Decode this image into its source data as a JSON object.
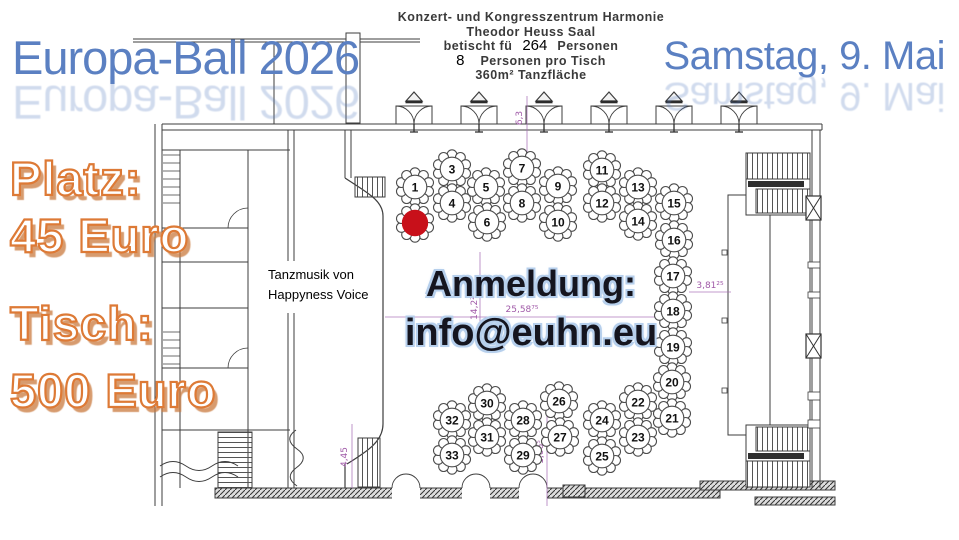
{
  "poster": {
    "title": "Europa-Ball 2026",
    "date": "Samstag, 9. Mai",
    "venue": {
      "line1": "Konzert- und Kongresszentrum Harmonie",
      "line2": "Theodor Heuss Saal",
      "seated_prefix": "betischt fü",
      "seated_count": "264",
      "seated_suffix": "Personen",
      "per_table_count": "8",
      "per_table_text": "Personen pro Tisch",
      "dance_floor": "360m² Tanzfläche"
    },
    "prices": {
      "seat_label": "Platz:",
      "seat_value": "45 Euro",
      "table_label": "Tisch:",
      "table_value": "500 Euro"
    },
    "music": {
      "line1": "Tanzmusik von",
      "line2": "Happyness Voice"
    },
    "registration": {
      "label": "Anmeldung:",
      "email": "info@euhn.eu"
    }
  },
  "floorplan": {
    "tables": [
      {
        "n": "1",
        "x": 415,
        "y": 187
      },
      {
        "n": "3",
        "x": 452,
        "y": 169
      },
      {
        "n": "4",
        "x": 452,
        "y": 203
      },
      {
        "n": "5",
        "x": 486,
        "y": 187
      },
      {
        "n": "6",
        "x": 487,
        "y": 222
      },
      {
        "n": "7",
        "x": 522,
        "y": 168
      },
      {
        "n": "8",
        "x": 522,
        "y": 203
      },
      {
        "n": "9",
        "x": 558,
        "y": 186
      },
      {
        "n": "10",
        "x": 558,
        "y": 222
      },
      {
        "n": "11",
        "x": 602,
        "y": 170
      },
      {
        "n": "12",
        "x": 602,
        "y": 203
      },
      {
        "n": "13",
        "x": 638,
        "y": 187
      },
      {
        "n": "14",
        "x": 638,
        "y": 221
      },
      {
        "n": "15",
        "x": 674,
        "y": 203
      },
      {
        "n": "16",
        "x": 674,
        "y": 240
      },
      {
        "n": "17",
        "x": 673,
        "y": 276
      },
      {
        "n": "18",
        "x": 673,
        "y": 311
      },
      {
        "n": "19",
        "x": 673,
        "y": 347
      },
      {
        "n": "20",
        "x": 672,
        "y": 382
      },
      {
        "n": "21",
        "x": 672,
        "y": 418
      },
      {
        "n": "22",
        "x": 638,
        "y": 402
      },
      {
        "n": "23",
        "x": 638,
        "y": 437
      },
      {
        "n": "24",
        "x": 602,
        "y": 420
      },
      {
        "n": "25",
        "x": 602,
        "y": 456
      },
      {
        "n": "26",
        "x": 559,
        "y": 401
      },
      {
        "n": "27",
        "x": 560,
        "y": 437
      },
      {
        "n": "28",
        "x": 523,
        "y": 420
      },
      {
        "n": "29",
        "x": 523,
        "y": 455
      },
      {
        "n": "30",
        "x": 487,
        "y": 403
      },
      {
        "n": "31",
        "x": 487,
        "y": 437
      },
      {
        "n": "32",
        "x": 452,
        "y": 420
      },
      {
        "n": "33",
        "x": 452,
        "y": 455
      }
    ],
    "sold_marker": {
      "x": 415,
      "y": 223
    },
    "dimensions": [
      {
        "text": "6,3",
        "x": 522,
        "y": 118,
        "rot": -90
      },
      {
        "text": "14,2²",
        "x": 477,
        "y": 308,
        "rot": -90
      },
      {
        "text": "25,58⁷⁵",
        "x": 522,
        "y": 312,
        "rot": 0
      },
      {
        "text": "3,81²⁵",
        "x": 710,
        "y": 288,
        "rot": 0
      },
      {
        "text": "4,45",
        "x": 347,
        "y": 457,
        "rot": -90
      },
      {
        "text": "1,66⁵",
        "x": 543,
        "y": 452,
        "rot": -90
      }
    ]
  },
  "colors": {
    "title_blue": "#5b80c2",
    "price_orange": "#dd7a36",
    "sold_red": "#c8101a",
    "dimension_purple": "#a05aa8",
    "plan_line": "#3d3d3d"
  }
}
